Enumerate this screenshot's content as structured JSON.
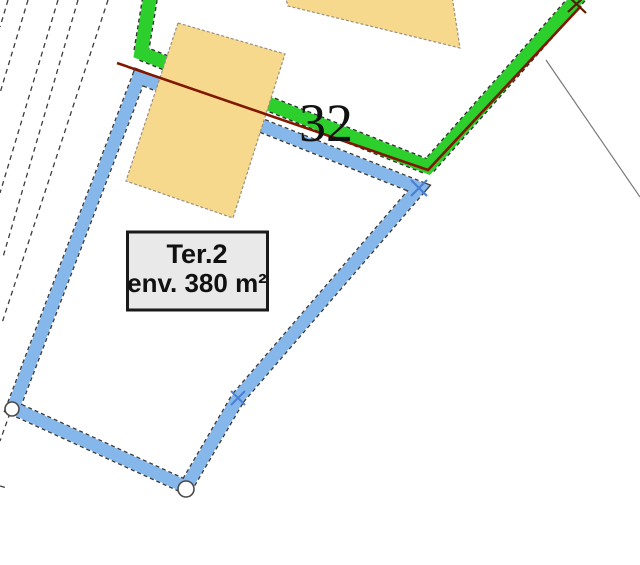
{
  "map": {
    "parcel_number": "32",
    "area_label": {
      "line1": "Ter.2",
      "line2": "env. 380 m²"
    },
    "colors": {
      "boundary_green": "#2CCF2C",
      "boundary_green_edge": "#2f2f2f",
      "parcel_blue": "#86B7EB",
      "parcel_edge_dash": "#3a3a3a",
      "building_fill": "#F7D98E",
      "building_stroke": "#9a9080",
      "red_line": "#801800",
      "survey_line": "#3c3c3c",
      "thin_line": "#7a7a7a",
      "cross_blue": "#4A7FD4",
      "cross_red": "#5a1a00",
      "circle_stroke": "#4a4a4a",
      "circle_fill": "#ffffff",
      "label_box_fill": "#E9E9E9",
      "label_box_border": "#1a1a1a",
      "text_color": "#111111"
    }
  }
}
